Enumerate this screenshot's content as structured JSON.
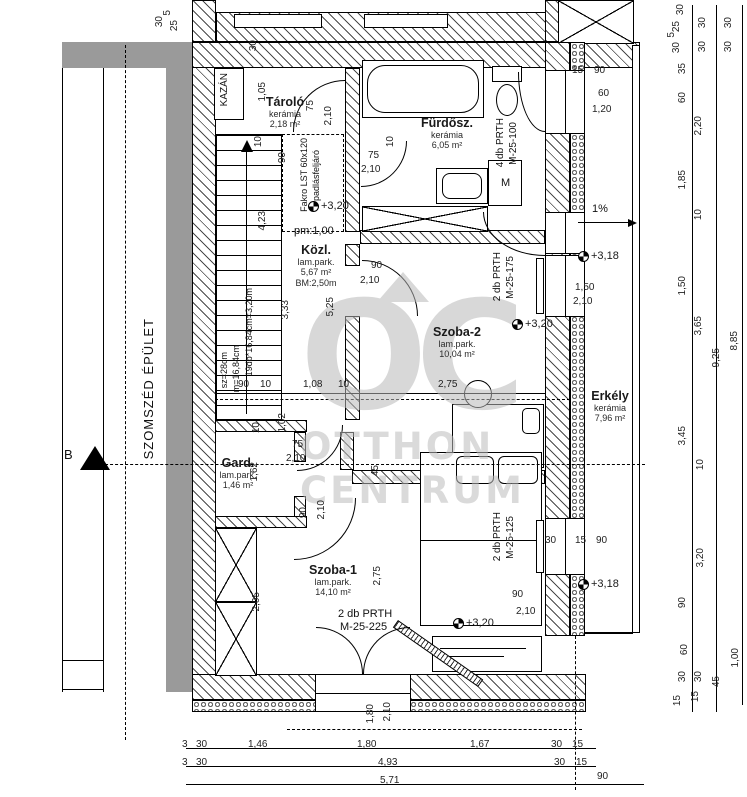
{
  "watermark": {
    "logo": "OC",
    "line1": "OTTHON",
    "line2": "CENTRUM"
  },
  "rooms": [
    {
      "name": "Tároló",
      "finish": "kerámia",
      "area": "2,18 m²",
      "x": 285,
      "y": 95
    },
    {
      "name": "Fürdősz.",
      "finish": "kerámia",
      "area": "6,05 m²",
      "x": 447,
      "y": 116
    },
    {
      "name": "Közl.",
      "finish": "lam.park.",
      "area": "5,67 m²",
      "extra": "BM:2,50m",
      "x": 316,
      "y": 243
    },
    {
      "name": "Szoba-2",
      "finish": "lam.park.",
      "area": "10,04 m²",
      "x": 457,
      "y": 325
    },
    {
      "name": "Erkély",
      "finish": "kerámia",
      "area": "7,96 m²",
      "x": 610,
      "y": 389
    },
    {
      "name": "Gard.",
      "finish": "lam.park.",
      "area": "1,46 m²",
      "x": 238,
      "y": 456
    },
    {
      "name": "Szoba-1",
      "finish": "lam.park.",
      "area": "14,10 m²",
      "x": 333,
      "y": 563
    }
  ],
  "labels": [
    {
      "t": "KAZÁN",
      "x": 220,
      "y": 73,
      "v": 1,
      "fs": 10
    },
    {
      "t": "SZOMSZÉD ÉPÜLET",
      "x": 142,
      "y": 318,
      "v": 1,
      "fs": 13,
      "ls": 1
    },
    {
      "t": "B",
      "x": 64,
      "y": 448,
      "fs": 13
    },
    {
      "t": "Fakro LST 60x120",
      "x": 300,
      "y": 138,
      "v": 1,
      "fs": 9
    },
    {
      "t": "padlásfeljáró",
      "x": 312,
      "y": 150,
      "v": 1,
      "fs": 9
    },
    {
      "t": "sz=28cm",
      "x": 220,
      "y": 352,
      "v": 1,
      "fs": 9
    },
    {
      "t": "m=16,84cm",
      "x": 232,
      "y": 345,
      "v": 1,
      "fs": 9
    },
    {
      "t": "19db*16,84cm=3,20m",
      "x": 245,
      "y": 288,
      "v": 1,
      "fs": 9
    },
    {
      "t": "pm:1,00",
      "x": 294,
      "y": 226,
      "fs": 11
    },
    {
      "t": "4 db PRTH",
      "x": 496,
      "y": 118,
      "v": 1,
      "fs": 10
    },
    {
      "t": "M-25-100",
      "x": 509,
      "y": 122,
      "v": 1,
      "fs": 10
    },
    {
      "t": "M",
      "x": 501,
      "y": 178,
      "fs": 11
    },
    {
      "t": "2 db PRTH",
      "x": 493,
      "y": 252,
      "v": 1,
      "fs": 10
    },
    {
      "t": "M-25-175",
      "x": 506,
      "y": 256,
      "v": 1,
      "fs": 10
    },
    {
      "t": "2 db PRTH",
      "x": 493,
      "y": 512,
      "v": 1,
      "fs": 10
    },
    {
      "t": "M-25-125",
      "x": 506,
      "y": 516,
      "v": 1,
      "fs": 10
    },
    {
      "t": "2 db PRTH",
      "x": 338,
      "y": 609,
      "fs": 11
    },
    {
      "t": "M-25-225",
      "x": 340,
      "y": 622,
      "fs": 11
    },
    {
      "t": "1%",
      "x": 592,
      "y": 204,
      "fs": 11
    }
  ],
  "levels": [
    {
      "t": "+3,20",
      "x": 308,
      "y": 200
    },
    {
      "t": "+3,20",
      "x": 512,
      "y": 318
    },
    {
      "t": "+3,20",
      "x": 453,
      "y": 617
    },
    {
      "t": "+3,18",
      "x": 578,
      "y": 250
    },
    {
      "t": "+3,18",
      "x": 578,
      "y": 578
    }
  ],
  "dims": [
    {
      "t": "1,05",
      "x": 258,
      "y": 82,
      "v": 1
    },
    {
      "t": "75",
      "x": 306,
      "y": 100,
      "v": 1
    },
    {
      "t": "2,10",
      "x": 324,
      "y": 106,
      "v": 1
    },
    {
      "t": "10",
      "x": 254,
      "y": 136,
      "v": 1
    },
    {
      "t": "90",
      "x": 278,
      "y": 152,
      "v": 1
    },
    {
      "t": "10",
      "x": 386,
      "y": 136,
      "v": 1
    },
    {
      "t": "75",
      "x": 368,
      "y": 151
    },
    {
      "t": "2,10",
      "x": 361,
      "y": 165
    },
    {
      "t": "90",
      "x": 371,
      "y": 261
    },
    {
      "t": "2,10",
      "x": 360,
      "y": 276
    },
    {
      "t": "3,33",
      "x": 281,
      "y": 300,
      "v": 1
    },
    {
      "t": "5,25",
      "x": 326,
      "y": 297,
      "v": 1
    },
    {
      "t": "4,23",
      "x": 258,
      "y": 211,
      "v": 1
    },
    {
      "t": "90",
      "x": 238,
      "y": 380
    },
    {
      "t": "10",
      "x": 260,
      "y": 380
    },
    {
      "t": "1,08",
      "x": 303,
      "y": 380
    },
    {
      "t": "10",
      "x": 338,
      "y": 380
    },
    {
      "t": "2,75",
      "x": 438,
      "y": 380
    },
    {
      "t": "10",
      "x": 252,
      "y": 422,
      "v": 1
    },
    {
      "t": "1,02",
      "x": 278,
      "y": 413,
      "v": 1
    },
    {
      "t": "75",
      "x": 292,
      "y": 440
    },
    {
      "t": "2,10",
      "x": 286,
      "y": 454
    },
    {
      "t": "1,62",
      "x": 250,
      "y": 462,
      "v": 1
    },
    {
      "t": "90",
      "x": 299,
      "y": 507,
      "v": 1
    },
    {
      "t": "2,10",
      "x": 317,
      "y": 500,
      "v": 1
    },
    {
      "t": "45",
      "x": 371,
      "y": 465,
      "v": 1
    },
    {
      "t": "2,05",
      "x": 252,
      "y": 592,
      "v": 1
    },
    {
      "t": "2,75",
      "x": 373,
      "y": 566,
      "v": 1
    },
    {
      "t": "1,80",
      "x": 366,
      "y": 704,
      "v": 1
    },
    {
      "t": "2,10",
      "x": 383,
      "y": 702,
      "v": 1
    },
    {
      "t": "1,50",
      "x": 575,
      "y": 283
    },
    {
      "t": "2,10",
      "x": 573,
      "y": 297
    },
    {
      "t": "90",
      "x": 512,
      "y": 590
    },
    {
      "t": "2,10",
      "x": 516,
      "y": 607
    },
    {
      "t": "30",
      "x": 545,
      "y": 536
    },
    {
      "t": "15",
      "x": 575,
      "y": 536
    },
    {
      "t": "90",
      "x": 596,
      "y": 536
    },
    {
      "t": "15",
      "x": 572,
      "y": 66
    },
    {
      "t": "90",
      "x": 594,
      "y": 66
    },
    {
      "t": "60",
      "x": 598,
      "y": 89
    },
    {
      "t": "1,20",
      "x": 592,
      "y": 105
    },
    {
      "t": "30",
      "x": 249,
      "y": 40,
      "v": 1
    },
    {
      "t": "30",
      "x": 155,
      "y": 16,
      "v": 1
    },
    {
      "t": "5",
      "x": 163,
      "y": 10,
      "v": 1
    },
    {
      "t": "25",
      "x": 170,
      "y": 20,
      "v": 1
    },
    {
      "t": "30",
      "x": 676,
      "y": 4,
      "v": 1
    },
    {
      "t": "25",
      "x": 672,
      "y": 21,
      "v": 1
    },
    {
      "t": "5",
      "x": 667,
      "y": 32,
      "v": 1
    },
    {
      "t": "30",
      "x": 672,
      "y": 42,
      "v": 1
    },
    {
      "t": "30",
      "x": 698,
      "y": 17,
      "v": 1
    },
    {
      "t": "30",
      "x": 698,
      "y": 41,
      "v": 1
    },
    {
      "t": "30",
      "x": 724,
      "y": 17,
      "v": 1
    },
    {
      "t": "30",
      "x": 724,
      "y": 41,
      "v": 1
    },
    {
      "t": "35",
      "x": 678,
      "y": 63,
      "v": 1
    },
    {
      "t": "60",
      "x": 678,
      "y": 92,
      "v": 1
    },
    {
      "t": "2,20",
      "x": 694,
      "y": 116,
      "v": 1
    },
    {
      "t": "1,85",
      "x": 678,
      "y": 170,
      "v": 1
    },
    {
      "t": "10",
      "x": 694,
      "y": 209,
      "v": 1
    },
    {
      "t": "1,50",
      "x": 678,
      "y": 276,
      "v": 1
    },
    {
      "t": "3,65",
      "x": 694,
      "y": 316,
      "v": 1
    },
    {
      "t": "9,25",
      "x": 712,
      "y": 348,
      "v": 1
    },
    {
      "t": "8,85",
      "x": 730,
      "y": 331,
      "v": 1
    },
    {
      "t": "3,45",
      "x": 678,
      "y": 426,
      "v": 1
    },
    {
      "t": "10",
      "x": 696,
      "y": 459,
      "v": 1
    },
    {
      "t": "3,20",
      "x": 696,
      "y": 548,
      "v": 1
    },
    {
      "t": "90",
      "x": 678,
      "y": 597,
      "v": 1
    },
    {
      "t": "60",
      "x": 680,
      "y": 644,
      "v": 1
    },
    {
      "t": "30",
      "x": 678,
      "y": 671,
      "v": 1
    },
    {
      "t": "15",
      "x": 673,
      "y": 695,
      "v": 1
    },
    {
      "t": "30",
      "x": 694,
      "y": 671,
      "v": 1
    },
    {
      "t": "15",
      "x": 691,
      "y": 691,
      "v": 1
    },
    {
      "t": "45",
      "x": 712,
      "y": 676,
      "v": 1
    },
    {
      "t": "1,00",
      "x": 731,
      "y": 648,
      "v": 1
    },
    {
      "t": "3",
      "x": 182,
      "y": 740
    },
    {
      "t": "30",
      "x": 196,
      "y": 740
    },
    {
      "t": "1,46",
      "x": 248,
      "y": 740
    },
    {
      "t": "1,80",
      "x": 357,
      "y": 740
    },
    {
      "t": "1,67",
      "x": 470,
      "y": 740
    },
    {
      "t": "30",
      "x": 551,
      "y": 740
    },
    {
      "t": "15",
      "x": 572,
      "y": 740
    },
    {
      "t": "3",
      "x": 182,
      "y": 758
    },
    {
      "t": "30",
      "x": 196,
      "y": 758
    },
    {
      "t": "4,93",
      "x": 378,
      "y": 758
    },
    {
      "t": "30",
      "x": 554,
      "y": 758
    },
    {
      "t": "15",
      "x": 576,
      "y": 758
    },
    {
      "t": "5,71",
      "x": 380,
      "y": 776
    },
    {
      "t": "90",
      "x": 597,
      "y": 772
    }
  ]
}
